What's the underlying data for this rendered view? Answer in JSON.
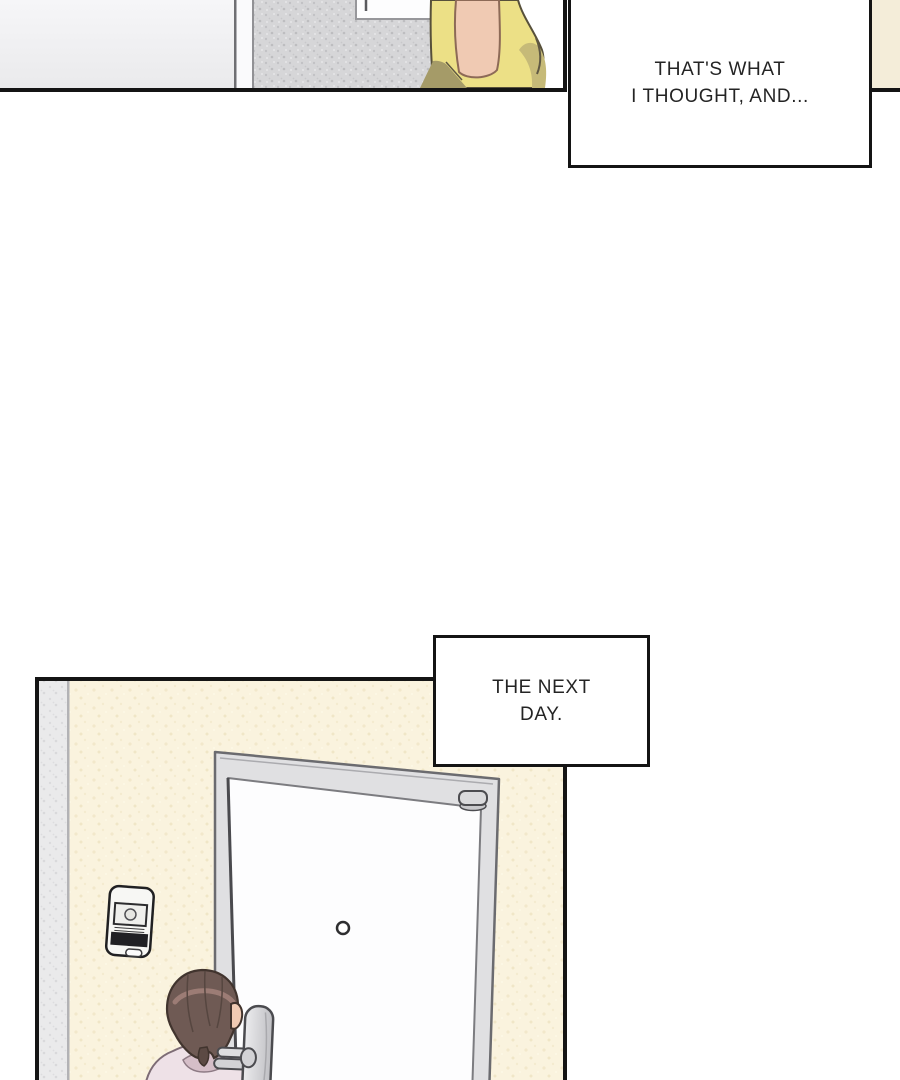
{
  "caption_top": {
    "line1": "THAT'S WHAT",
    "line2": "I THOUGHT, AND..."
  },
  "caption_next_day": {
    "line1": "THE NEXT",
    "line2": "DAY."
  },
  "colors": {
    "panel_border": "#141414",
    "caption_bg": "#ffffff",
    "caption_text": "#242424",
    "beige_panel": "#f4edd9",
    "plain_wall_top": "#f6f6f8",
    "plain_wall_bottom": "#eaeaec",
    "gray_wall": "#d6d6d8",
    "window_frame": "#fdfdfe",
    "yellow_shirt": "#ece086",
    "yellow_shadow": "#a59b68",
    "yellow_shade": "#c6ba78",
    "skin": "#f0cab3",
    "cream_wall": "#faf3de",
    "gray_strip": "#eaeaeb",
    "door_frame": "#e0e0e2",
    "door_face": "#fdfdfe",
    "hair": "#6f5a54",
    "hair_highlight": "#a5827b",
    "pink_shirt": "#eee1e7",
    "collar": "#d5bec8",
    "lock_metal": "#d6d6d9",
    "intercom_body": "#f7f7f4",
    "intercom_band": "#202024"
  }
}
